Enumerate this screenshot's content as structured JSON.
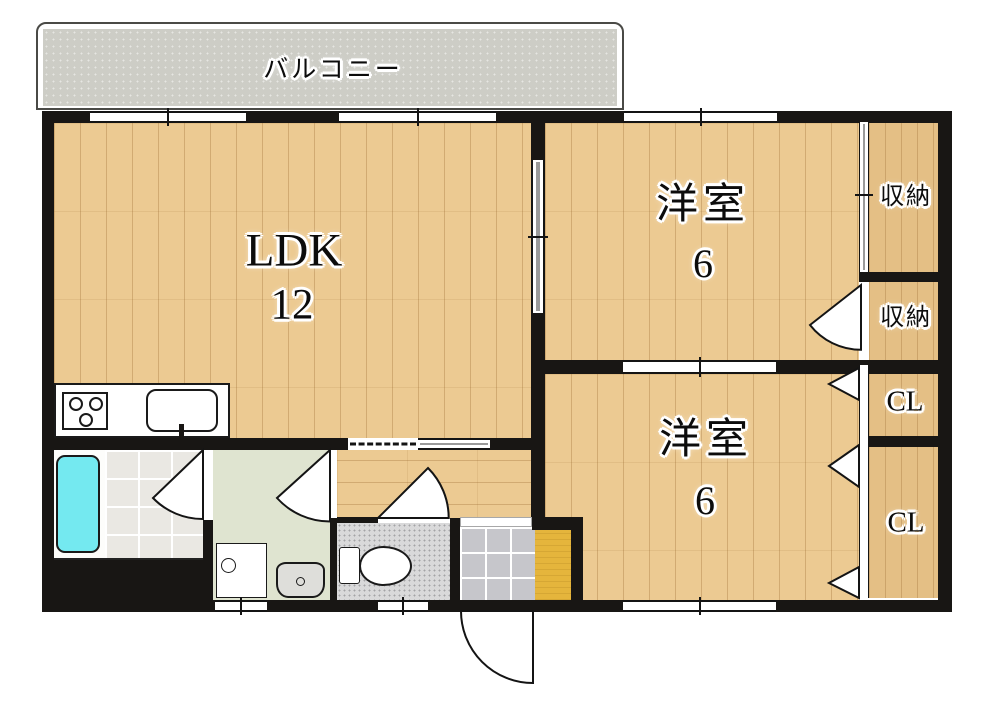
{
  "plan_title": "2LDK apartment floor plan",
  "labels": {
    "balcony": "バルコニー",
    "ldk": {
      "name": "LDK",
      "size": "12"
    },
    "western_room_top": {
      "name": "洋室",
      "size": "6"
    },
    "western_room_bottom": {
      "name": "洋室",
      "size": "6"
    },
    "storage_top": "収納",
    "storage_bottom": "収納",
    "closet_top": "CL",
    "closet_bottom": "CL"
  },
  "colors": {
    "wall": "#181614",
    "wood": "#ecca92",
    "closet_wood": "#e4bf85",
    "balcony": "#cdcdc6",
    "bath_floor": "#eae8e3",
    "bathtub": "#74e9f0",
    "washroom": "#dfe4d0",
    "toilet_floor": "#d9d9da",
    "entry_tile": "#c6c6cb",
    "entry_mat": "#e5b53c"
  }
}
